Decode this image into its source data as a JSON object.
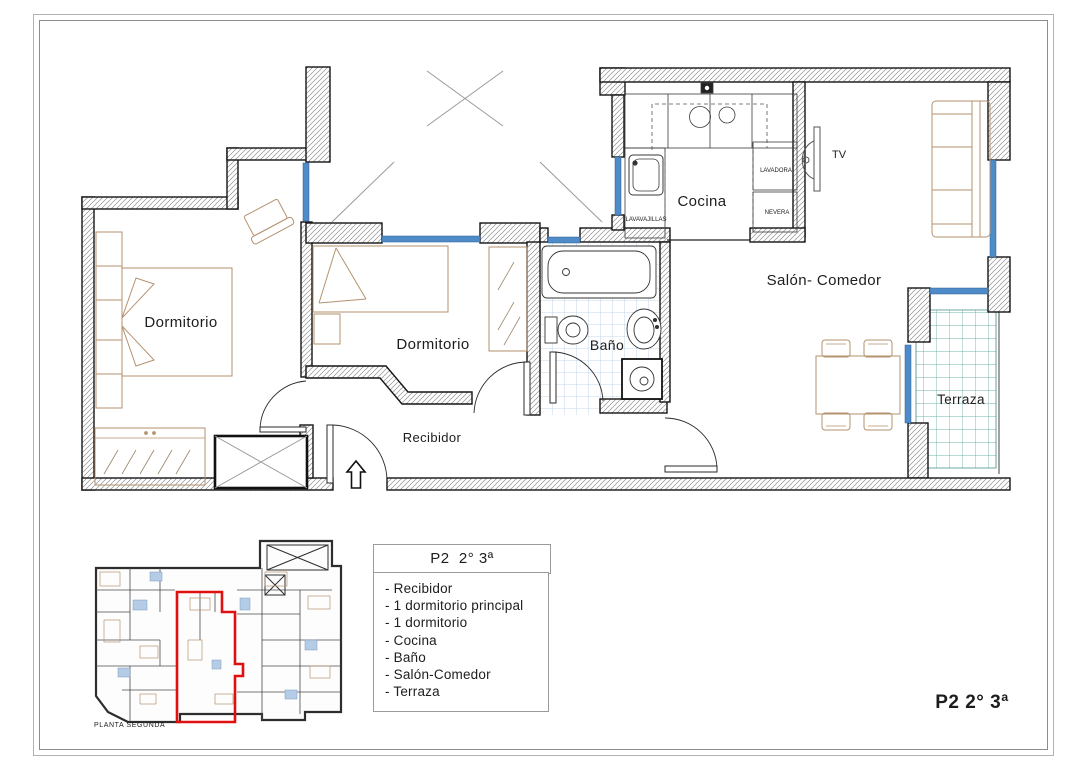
{
  "sheet": {
    "code": "P2 2° 3ª"
  },
  "legend": {
    "title": "P2  2° 3ª",
    "items": [
      "- Recibidor",
      "- 1 dormitorio principal",
      "- 1 dormitorio",
      "- Cocina",
      "- Baño",
      "- Salón-Comedor",
      "- Terraza"
    ]
  },
  "minimap": {
    "caption": "PLANTA SEGUNDA"
  },
  "floor_plan": {
    "labels": {
      "dormitorio_principal": "Dormitorio",
      "dormitorio_2": "Dormitorio",
      "bano": "Baño",
      "cocina": "Cocina",
      "salon_comedor": "Salón- Comedor",
      "terraza": "Terraza",
      "recibidor": "Recibidor",
      "tv": "TV",
      "lavadora": "LAVADORA",
      "nevera": "NEVERA",
      "lavavajillas": "LAVAVAJILLAS"
    },
    "colors": {
      "window": "#4e8bc8",
      "wall_outline": "#141414",
      "wall_hatch": "#909090",
      "furniture": "#b4926f",
      "bath_tile": "#b5cce6",
      "terrace_tile": "#72b4ab",
      "highlight_red": "#e01010"
    }
  }
}
